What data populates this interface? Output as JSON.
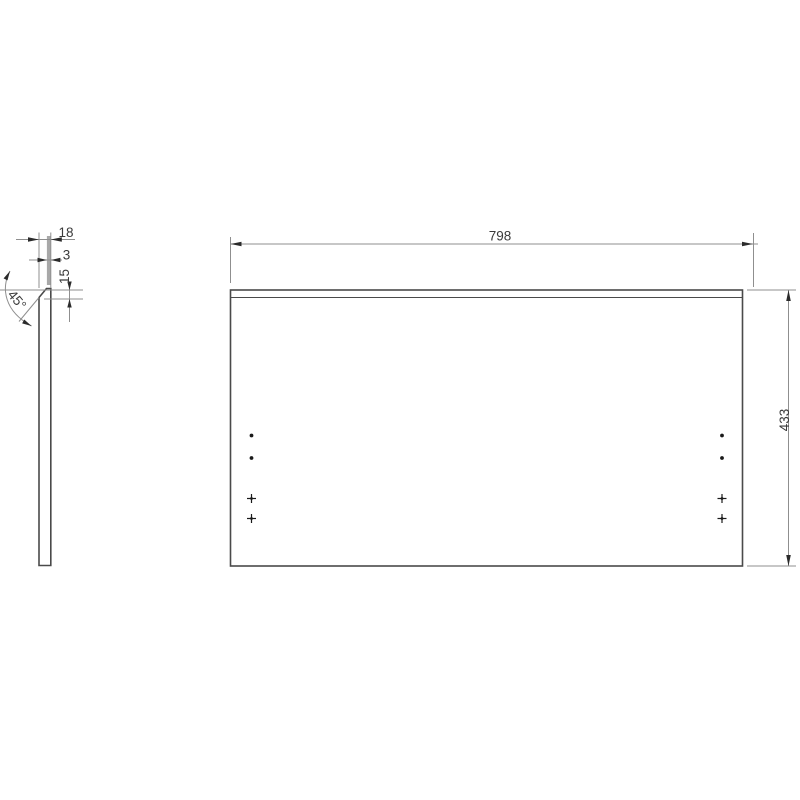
{
  "drawing": {
    "type": "technical-panel-drawing",
    "front_view": {
      "width_dim": "798",
      "height_dim": "433",
      "hole_columns": 2,
      "hole_marks_per_column": [
        "dot",
        "dot",
        "cross",
        "cross"
      ]
    },
    "side_view": {
      "thickness_dim": "18",
      "strip_dim": "3",
      "chamfer_dim": "15",
      "angle_dim": "45°"
    },
    "colors": {
      "object_line": "#4a4a4a",
      "dimension_line": "#8f8f8f",
      "arrow": "#2b2b2b",
      "text": "#3a3a3a",
      "edge_strip": "#a8a8a8",
      "background": "#ffffff"
    }
  }
}
